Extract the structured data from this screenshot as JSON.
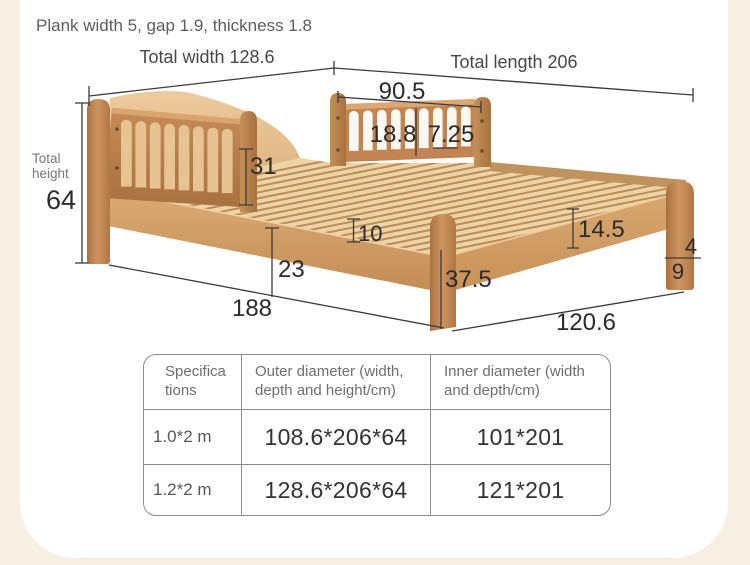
{
  "note": "Plank width 5, gap 1.9, thickness 1.8",
  "colors": {
    "background": "#f6efe2",
    "card": "#ffffff",
    "wood_light": "#e9c697",
    "wood_dark": "#bc7f4e",
    "dimension_line": "#3a3a3a"
  },
  "dims": {
    "total_width": "Total width 128.6",
    "total_length": "Total length 206",
    "total_height_label": "Total height",
    "total_height": "64",
    "guard_rail_width": "90.5",
    "slat_spacing": "18.8",
    "slat_width": "7.25",
    "guard_rail_height": "31",
    "frame_thickness": "10",
    "under_bed_clearance": "23",
    "front_span_left": "188",
    "front_span_right": "120.6",
    "leg_height": "37.5",
    "side_rail_height": "14.5",
    "foot_upper": "4",
    "foot_lower": "9"
  },
  "table": {
    "headers": [
      "Specifica\ntions",
      "Outer diameter (width, depth and height/cm)",
      "Inner diameter (width and depth/cm)"
    ],
    "rows": [
      {
        "spec": "1.0*2 m",
        "outer": "108.6*206*64",
        "inner": "101*201"
      },
      {
        "spec": "1.2*2 m",
        "outer": "128.6*206*64",
        "inner": "121*201"
      }
    ]
  }
}
